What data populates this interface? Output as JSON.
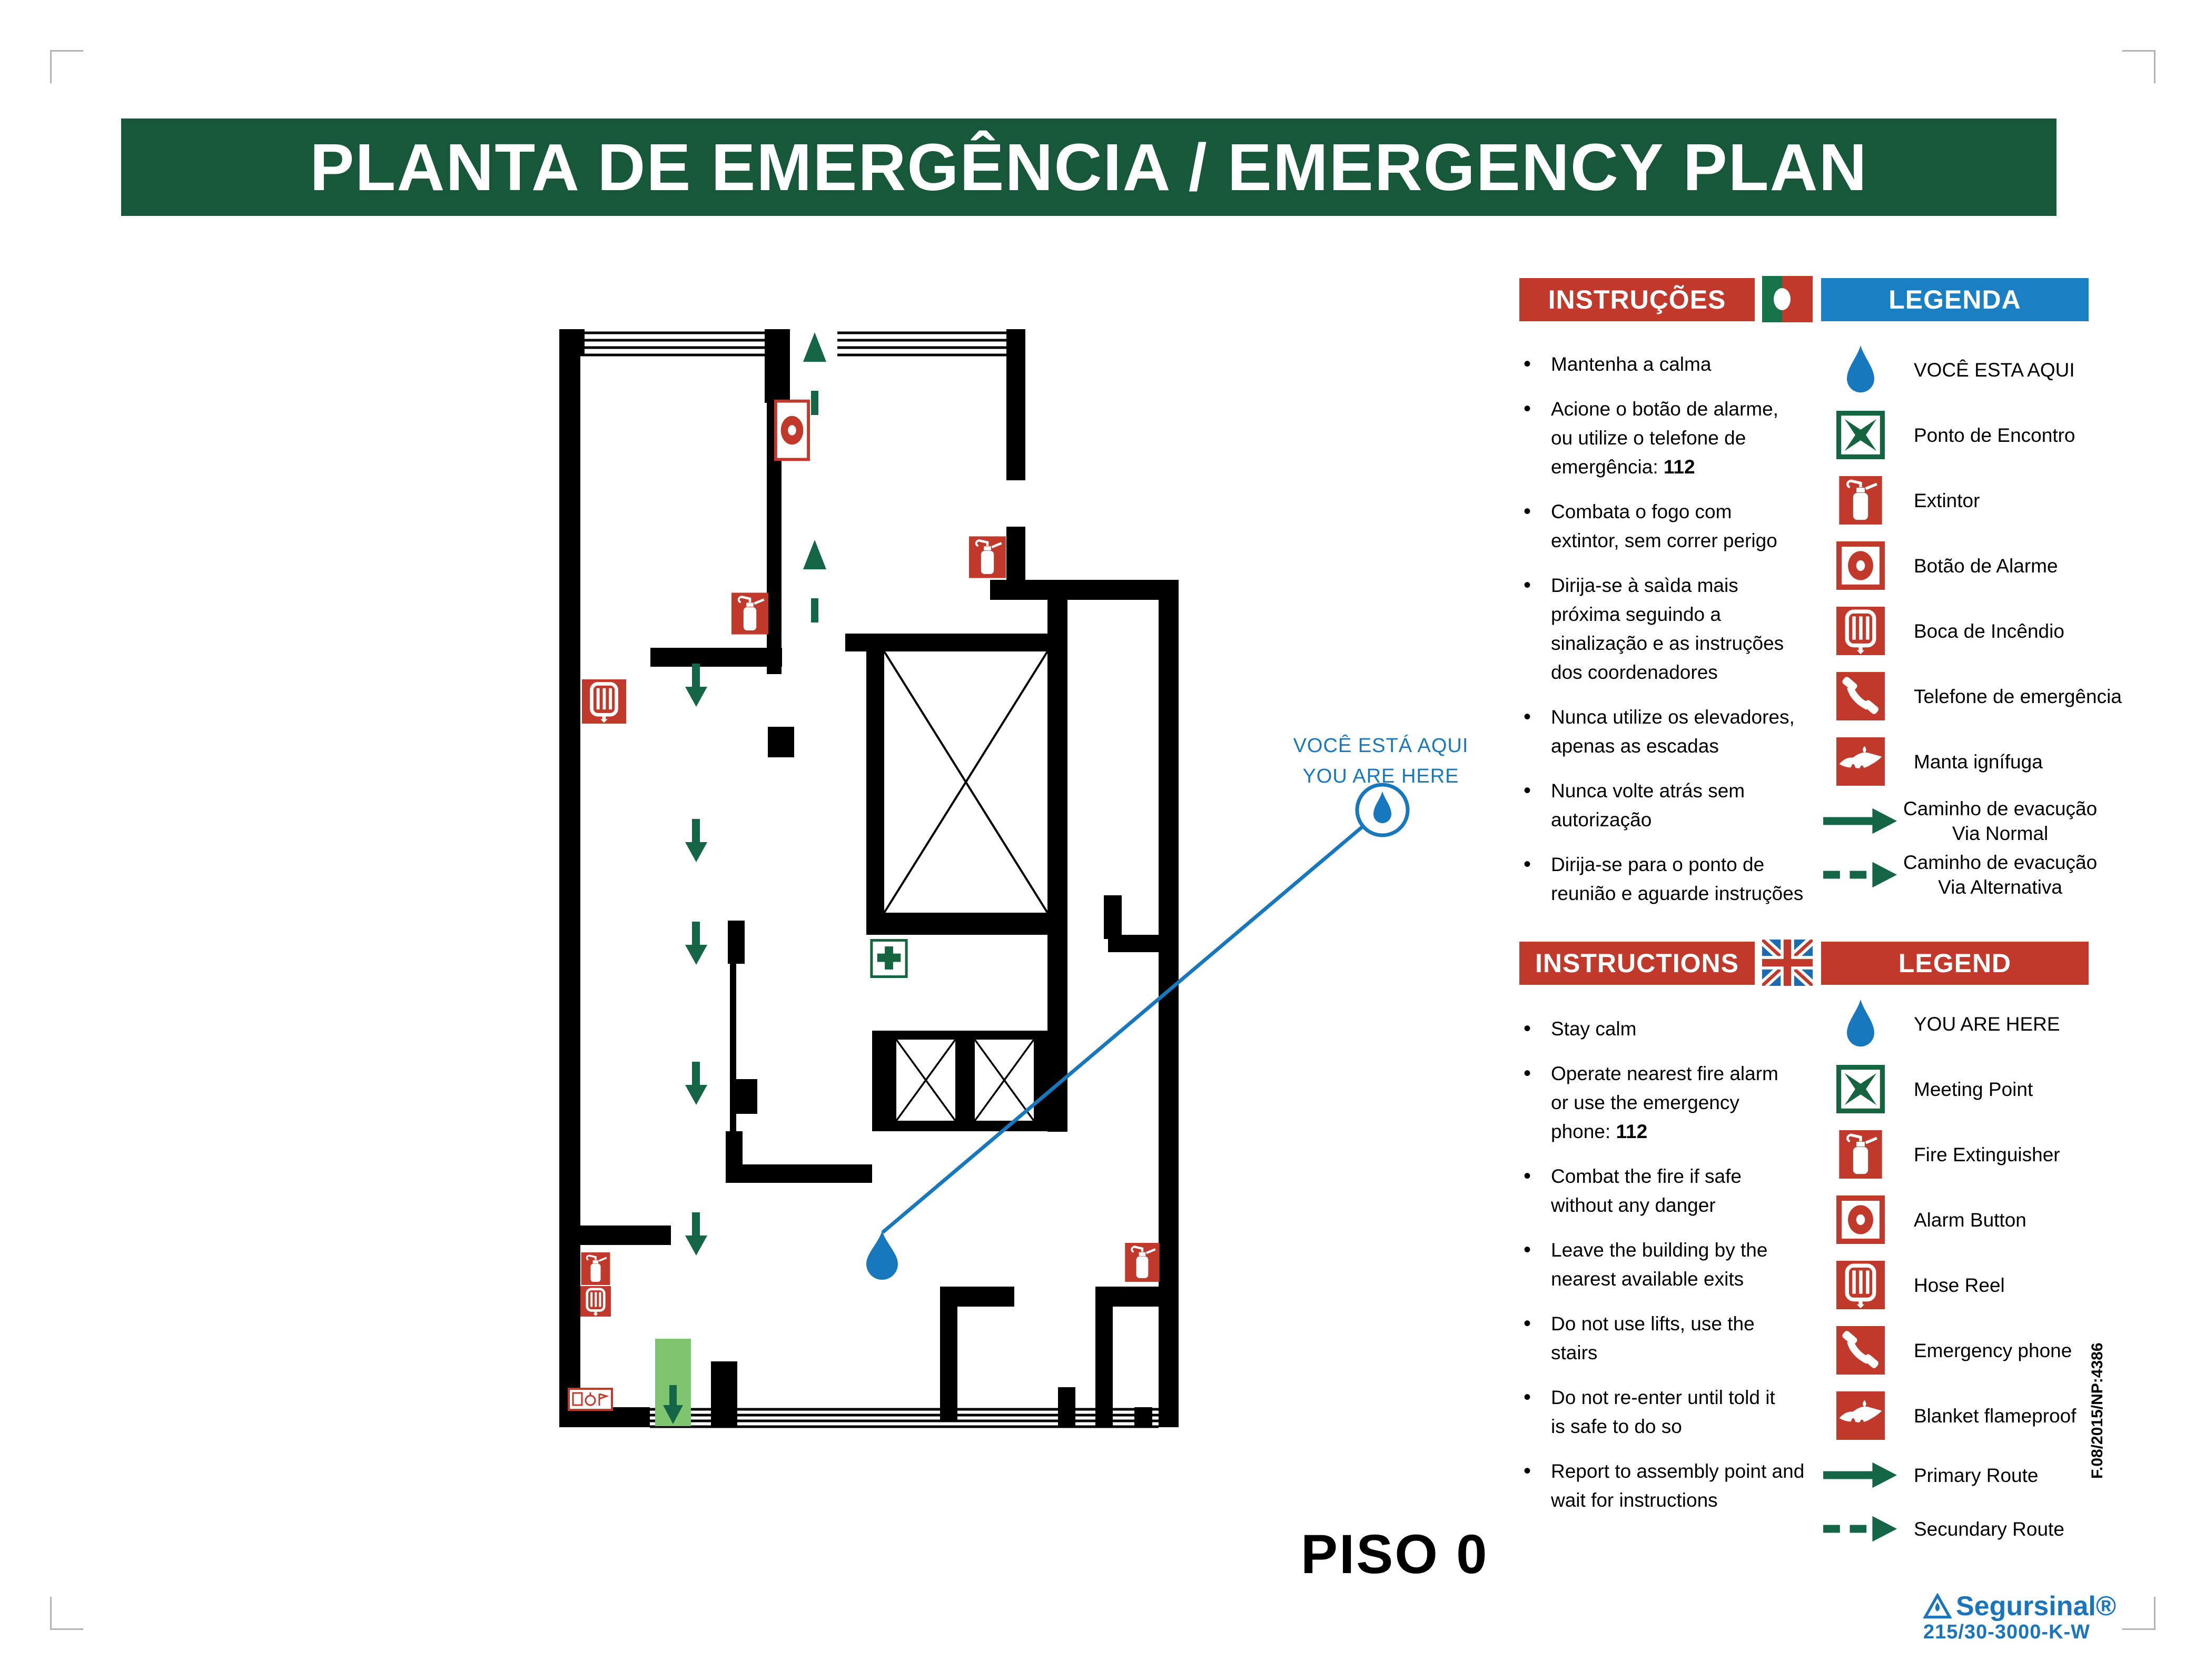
{
  "title": "PLANTA DE EMERGÊNCIA / EMERGENCY PLAN",
  "floor_label": "PISO 0",
  "callout": {
    "line1": "VOCÊ ESTÁ AQUI",
    "line2": "YOU ARE HERE"
  },
  "colors": {
    "header_green": "#17583a",
    "banner_red": "#c0392b",
    "banner_blue": "#1b7fc4",
    "route_green": "#156647",
    "marker_blue": "#1878bd",
    "exit_green": "#7fc46f",
    "brand_blue": "#1b75bc"
  },
  "pt": {
    "instructions_title": "INSTRUÇÕES",
    "legend_title": "LEGENDA",
    "flag_icon": "portugal-flag",
    "instructions": [
      {
        "lines": [
          "Mantenha a calma"
        ]
      },
      {
        "lines": [
          "Acione o botão de alarme,",
          "ou utilize o telefone de",
          "emergência: **112**"
        ]
      },
      {
        "lines": [
          "Combata o fogo com",
          "extintor, sem correr perigo"
        ]
      },
      {
        "lines": [
          "Dirija-se à saìda mais",
          "próxima seguindo a",
          "sinalização e as instruções",
          "dos coordenadores"
        ]
      },
      {
        "lines": [
          "Nunca utilize os elevadores,",
          "apenas as escadas"
        ]
      },
      {
        "lines": [
          "Nunca volte atrás sem",
          "autorização"
        ]
      },
      {
        "lines": [
          "Dirija-se para o ponto de",
          "reunião e aguarde instruções"
        ]
      }
    ],
    "legend": [
      {
        "icon": "you-are-here",
        "lines": [
          "VOCÊ ESTA AQUI"
        ]
      },
      {
        "icon": "meeting-point",
        "lines": [
          "Ponto de Encontro"
        ]
      },
      {
        "icon": "fire-extinguisher",
        "lines": [
          "Extintor"
        ]
      },
      {
        "icon": "alarm-button",
        "lines": [
          "Botão de Alarme"
        ]
      },
      {
        "icon": "hose-reel",
        "lines": [
          "Boca de Incêndio"
        ]
      },
      {
        "icon": "emergency-phone",
        "lines": [
          "Telefone de emergência"
        ]
      },
      {
        "icon": "fire-blanket",
        "lines": [
          "Manta ignífuga"
        ]
      },
      {
        "icon": "route-primary",
        "lines": [
          "Caminho de evacução",
          "Via Normal"
        ]
      },
      {
        "icon": "route-secondary",
        "lines": [
          "Caminho de evacução",
          "Via Alternativa"
        ]
      }
    ]
  },
  "en": {
    "instructions_title": "INSTRUCTIONS",
    "legend_title": "LEGEND",
    "flag_icon": "uk-flag",
    "instructions": [
      {
        "lines": [
          "Stay calm"
        ]
      },
      {
        "lines": [
          "Operate nearest fire alarm",
          "or use the emergency",
          "phone: **112**"
        ]
      },
      {
        "lines": [
          "Combat the fire if safe",
          "without any danger"
        ]
      },
      {
        "lines": [
          "Leave the building by the",
          "nearest available exits"
        ]
      },
      {
        "lines": [
          "Do not use lifts, use the",
          "stairs"
        ]
      },
      {
        "lines": [
          "Do not re-enter until told it",
          "is safe to do so"
        ]
      },
      {
        "lines": [
          "Report to assembly point and",
          "wait for instructions"
        ]
      }
    ],
    "legend": [
      {
        "icon": "you-are-here",
        "lines": [
          "YOU ARE HERE"
        ]
      },
      {
        "icon": "meeting-point",
        "lines": [
          "Meeting Point"
        ]
      },
      {
        "icon": "fire-extinguisher",
        "lines": [
          "Fire Extinguisher"
        ]
      },
      {
        "icon": "alarm-button",
        "lines": [
          "Alarm Button"
        ]
      },
      {
        "icon": "hose-reel",
        "lines": [
          "Hose Reel"
        ]
      },
      {
        "icon": "emergency-phone",
        "lines": [
          "Emergency phone"
        ]
      },
      {
        "icon": "fire-blanket",
        "lines": [
          "Blanket flameproof"
        ]
      },
      {
        "icon": "route-primary",
        "lines": [
          "Primary Route"
        ]
      },
      {
        "icon": "route-secondary",
        "lines": [
          "Secundary Route"
        ]
      }
    ]
  },
  "footer": {
    "doc_ref": "F.08/2015/NP:4386",
    "brand": "Segursinal®",
    "model": "215/30-3000-K-W"
  },
  "plan_markers": [
    "you-are-here-drop",
    "alarm-button",
    "fire-extinguisher",
    "hose-reel",
    "first-aid-cross",
    "emergency-exit",
    "primary-route-arrow",
    "secondary-route-arrow",
    "stairwell",
    "elevator",
    "fire-equipment-sign"
  ]
}
